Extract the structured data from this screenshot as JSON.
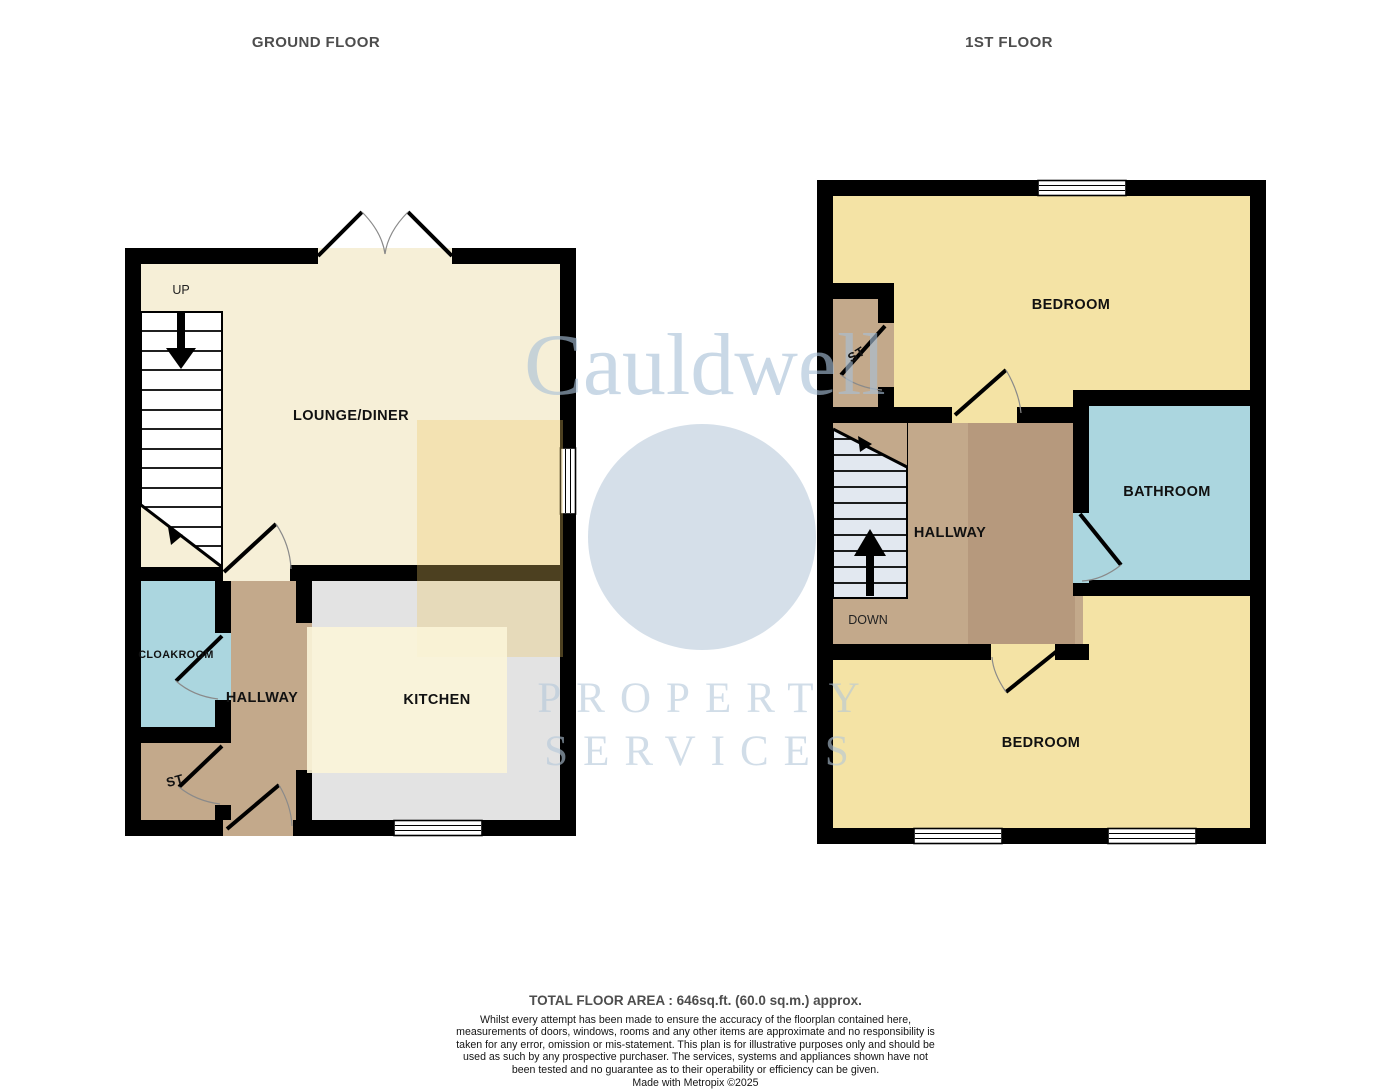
{
  "titles": {
    "ground": "GROUND FLOOR",
    "first": "1ST FLOOR"
  },
  "ground_floor": {
    "rooms": {
      "lounge": "LOUNGE/DINER",
      "kitchen": "KITCHEN",
      "hallway": "HALLWAY",
      "cloakroom": "CLOAKROOM",
      "store": "ST"
    },
    "stairs_label": "UP"
  },
  "first_floor": {
    "rooms": {
      "bedroom1": "BEDROOM",
      "bedroom2": "BEDROOM",
      "bathroom": "BATHROOM",
      "hallway": "HALLWAY",
      "store": "ST"
    },
    "stairs_label": "DOWN"
  },
  "watermark": {
    "brand": "Cauldwell",
    "line1": "PROPERTY",
    "line2": "SERVICES"
  },
  "footer": {
    "total_area": "TOTAL FLOOR AREA : 646sq.ft. (60.0 sq.m.) approx.",
    "disclaimer": "Whilst every attempt has been made to ensure the accuracy of the floorplan contained here, measurements of doors, windows, rooms and any other items are approximate and no responsibility is taken for any error, omission or mis-statement. This plan is for illustrative purposes only and should be used as such by any prospective purchaser. The services, systems and appliances shown have not been tested and no guarantee as to their operability or efficiency can be given.",
    "credit": "Made with Metropix ©2025"
  },
  "colors": {
    "wall": "#000000",
    "cream": "#f6efd7",
    "gray": "#e3e3e3",
    "yellow": "#f4e3a5",
    "blue": "#abd6df",
    "tan": "#c3a98b",
    "tan_dark": "#b29478",
    "stair_tint": "#e2e8f0",
    "white": "#ffffff",
    "arc": "#8a8a8a",
    "wm_yellow": "#ecc864",
    "wm_blue": "#c7d4e2",
    "wm_cream": "#fbf4d8"
  }
}
